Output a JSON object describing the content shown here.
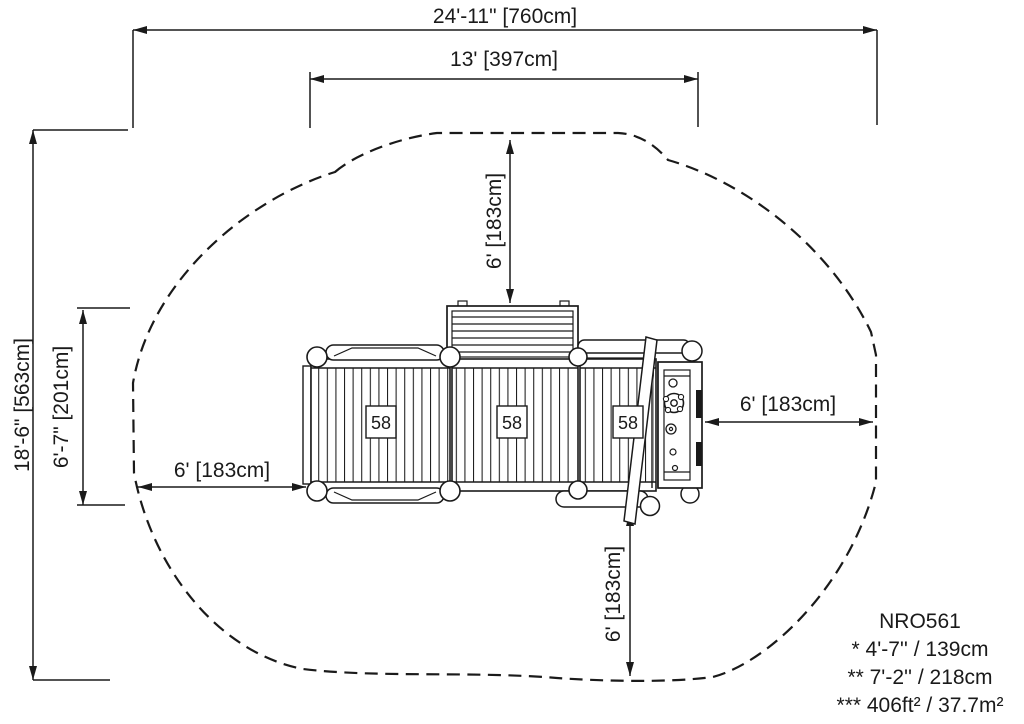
{
  "title_block": {
    "product_code": "NRO561",
    "note_1": "* 4'-7'' / 139cm",
    "note_2": "** 7'-2'' / 218cm",
    "note_3": "*** 406ft² / 37.7m²"
  },
  "dimensions": {
    "overall_width": "24'-11\" [760cm]",
    "inner_width": "13' [397cm]",
    "overall_depth": "18'-6\" [563cm]",
    "inner_depth": "6'-7\" [201cm]",
    "clearance_left": "6' [183cm]",
    "clearance_top": "6' [183cm]",
    "clearance_right": "6' [183cm]",
    "clearance_bottom": "6' [183cm]"
  },
  "structure": {
    "deck_labels": [
      "58",
      "58",
      "58"
    ]
  },
  "colors": {
    "line": "#1a1a1a",
    "background": "#ffffff"
  }
}
